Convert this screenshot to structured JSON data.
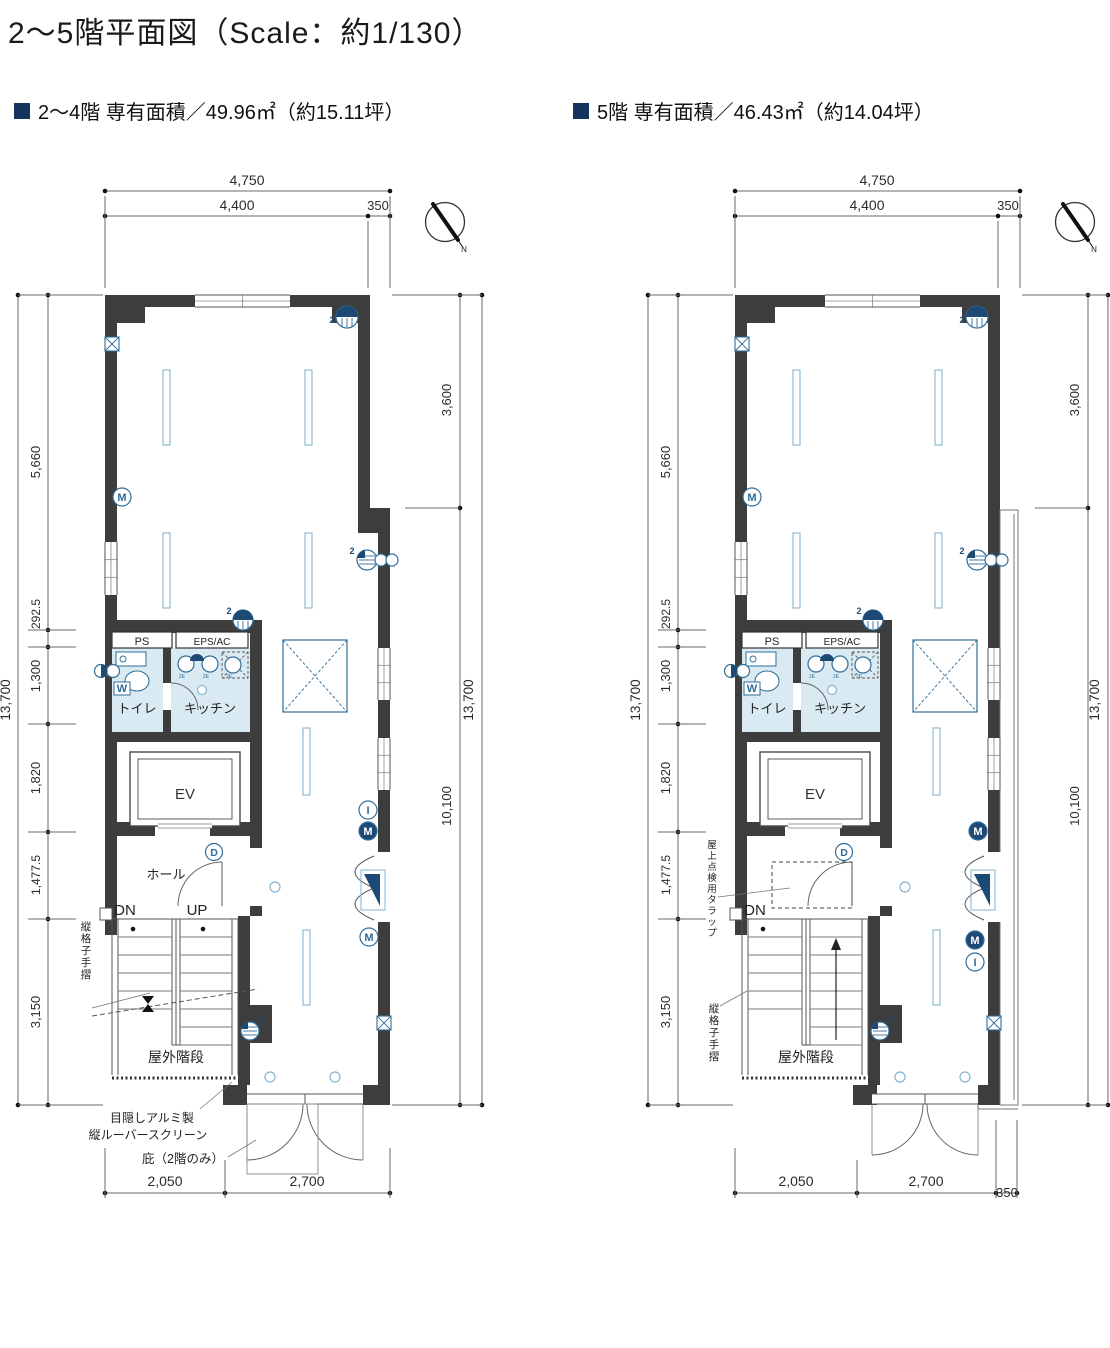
{
  "page": {
    "title": "2〜5階平面図（Scale：約1/130）"
  },
  "colors": {
    "wall": "#3d3d3d",
    "accent_square": "#16355e",
    "symbol_blue": "#2f6d99",
    "symbol_navy": "#1c4a74",
    "room_fill": "#daeaf3",
    "light_blue": "#86b4d2",
    "dim_line": "#6a6a6a",
    "dim_text": "#2b2b2b"
  },
  "plans": [
    {
      "id": "plan-2-4f",
      "variant": "typical",
      "header": "2〜4階 専有面積／49.96㎡（約15.11坪）",
      "dimensions": {
        "top_total": "4,750",
        "top_main": "4,400",
        "top_offset": "350",
        "left_overall": "13,700",
        "left_segments": [
          "5,660",
          "292.5",
          "1,300",
          "1,820",
          "1,477.5",
          "3,150"
        ],
        "right_overall": "13,700",
        "right_upper": "3,600",
        "right_lower": "10,100",
        "bottom_segments": [
          "2,050",
          "2,700"
        ]
      },
      "rooms": {
        "ps": "PS",
        "eps_ac": "EPS/AC",
        "toilet": "トイレ",
        "kitchen": "キッチン",
        "elevator": "EV",
        "hall": "ホール",
        "outdoor_stairs": "屋外階段"
      },
      "stairs": {
        "down": "DN",
        "up": "UP"
      },
      "annotations": {
        "handrail": "縦格子手摺",
        "louver_line1": "目隠しアルミ製",
        "louver_line2": "縦ルーバースクリーン",
        "canopy": "庇（2階のみ）"
      }
    },
    {
      "id": "plan-5f",
      "variant": "top_floor",
      "header": "5階 専有面積／46.43㎡（約14.04坪）",
      "dimensions": {
        "top_total": "4,750",
        "top_main": "4,400",
        "top_offset": "350",
        "left_overall": "13,700",
        "left_segments": [
          "5,660",
          "292.5",
          "1,300",
          "1,820",
          "1,477.5",
          "3,150"
        ],
        "right_overall": "13,700",
        "right_upper": "3,600",
        "right_lower": "10,100",
        "bottom_segments": [
          "2,050",
          "2,700",
          "350"
        ]
      },
      "rooms": {
        "ps": "PS",
        "eps_ac": "EPS/AC",
        "toilet": "トイレ",
        "kitchen": "キッチン",
        "elevator": "EV",
        "outdoor_stairs": "屋外階段"
      },
      "stairs": {
        "down": "DN"
      },
      "annotations": {
        "handrail": "縦格子手摺",
        "roof_hatch": "屋上点検用タラップ"
      }
    }
  ],
  "symbols": {
    "north": "N",
    "door": "D",
    "meter_m": "M",
    "meter_i": "I",
    "water": "W",
    "count_two": "2",
    "fixture_tag": "2E"
  }
}
